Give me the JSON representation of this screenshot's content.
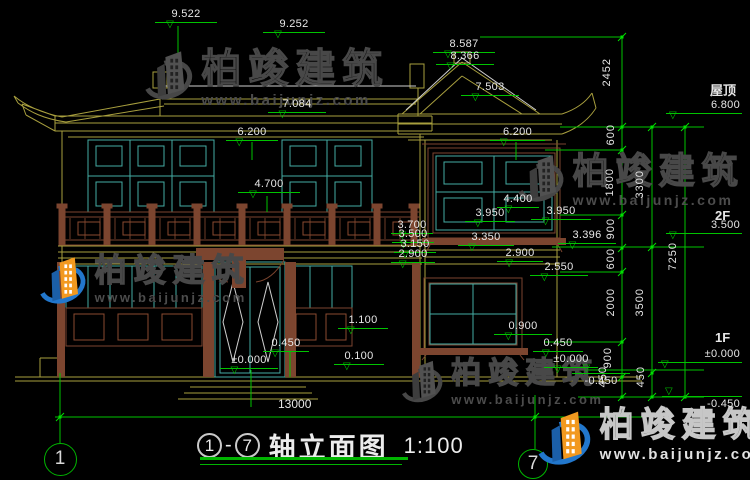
{
  "canvas": {
    "width": 750,
    "height": 480,
    "background": "#000000"
  },
  "colors": {
    "linework_yellow": "#a89f3e",
    "linework_white": "#cfcfcf",
    "window_teal": "#45aca3",
    "wood_brown": "#7c452f",
    "dimension_green": "#00c400",
    "text": "#e6e6e6",
    "logo_blue": "#2277cc",
    "logo_orange": "#f2991f"
  },
  "title": {
    "axis_from": "1",
    "dash": "-",
    "axis_to": "7",
    "label": "轴立面图",
    "scale": "1:100"
  },
  "axis_bubbles": [
    {
      "n": "1",
      "cx": 60,
      "cy": 459,
      "d": 33
    },
    {
      "n": "7",
      "cx": 533,
      "cy": 464,
      "d": 30
    }
  ],
  "watermarks": {
    "brand": "柏竣建筑",
    "url": "www.baijunjz.com",
    "placements": [
      {
        "x": 143,
        "y": 48,
        "variant": "gray",
        "logo_h": 58,
        "brand_size": 40,
        "url_size": 15
      },
      {
        "x": 516,
        "y": 152,
        "variant": "gray",
        "logo_h": 56,
        "brand_size": 36,
        "url_size": 14
      },
      {
        "x": 38,
        "y": 254,
        "variant": "color",
        "logo_h": 56,
        "brand_size": 32,
        "url_size": 13
      },
      {
        "x": 400,
        "y": 358,
        "variant": "gray",
        "logo_h": 50,
        "brand_size": 30,
        "url_size": 13
      },
      {
        "x": 536,
        "y": 408,
        "variant": "bright",
        "logo_h": 64,
        "brand_size": 34,
        "url_size": 15
      }
    ]
  },
  "annotations": {
    "elevations": [
      {
        "t": "9.522",
        "x": 155,
        "y": 8,
        "w": 62
      },
      {
        "t": "9.252",
        "x": 263,
        "y": 18,
        "w": 62
      },
      {
        "t": "8.587",
        "x": 433,
        "y": 38,
        "w": 62
      },
      {
        "t": "8.366",
        "x": 436,
        "y": 50,
        "w": 58
      },
      {
        "t": "7.503",
        "x": 461,
        "y": 81,
        "w": 58
      },
      {
        "t": "7.084",
        "x": 268,
        "y": 98,
        "w": 58
      },
      {
        "t": "6.200",
        "x": 226,
        "y": 126,
        "w": 52
      },
      {
        "t": "6.200",
        "x": 490,
        "y": 126,
        "w": 55
      },
      {
        "t": "4.700",
        "x": 238,
        "y": 178,
        "w": 62
      },
      {
        "t": "4.400",
        "x": 497,
        "y": 193,
        "w": 42
      },
      {
        "t": "3.950",
        "x": 465,
        "y": 207,
        "w": 50
      },
      {
        "t": "3.950",
        "x": 531,
        "y": 205,
        "w": 60
      },
      {
        "t": "3.700",
        "x": 391,
        "y": 219,
        "w": 42
      },
      {
        "t": "3.500",
        "x": 392,
        "y": 228,
        "w": 42
      },
      {
        "t": "3.350",
        "x": 458,
        "y": 231,
        "w": 56
      },
      {
        "t": "3.396",
        "x": 558,
        "y": 229,
        "w": 58
      },
      {
        "t": "3.150",
        "x": 394,
        "y": 238,
        "w": 42
      },
      {
        "t": "2.900",
        "x": 391,
        "y": 248,
        "w": 44
      },
      {
        "t": "2.900",
        "x": 497,
        "y": 247,
        "w": 46
      },
      {
        "t": "2.550",
        "x": 530,
        "y": 261,
        "w": 58
      },
      {
        "t": "1.100",
        "x": 338,
        "y": 314,
        "w": 50
      },
      {
        "t": "0.900",
        "x": 494,
        "y": 320,
        "w": 58
      },
      {
        "t": "0.450",
        "x": 263,
        "y": 337,
        "w": 46
      },
      {
        "t": "0.450",
        "x": 533,
        "y": 337,
        "w": 50
      },
      {
        "t": "0.100",
        "x": 334,
        "y": 350,
        "w": 50
      },
      {
        "t": "±0.000",
        "x": 220,
        "y": 354,
        "w": 58
      },
      {
        "t": "±0.000",
        "x": 544,
        "y": 353,
        "w": 54
      },
      {
        "t": "-0.450",
        "x": 572,
        "y": 373,
        "w": 58,
        "below": true
      },
      {
        "t": "6.800",
        "x": 666,
        "y": 99,
        "w": 76,
        "k": "level"
      },
      {
        "t": "3.500",
        "x": 666,
        "y": 219,
        "w": 76,
        "k": "level"
      },
      {
        "t": "±0.000",
        "x": 658,
        "y": 348,
        "w": 84,
        "k": "level"
      },
      {
        "t": "-0.450",
        "x": 662,
        "y": 396,
        "w": 80,
        "k": "level",
        "below": true
      }
    ],
    "chains": [
      {
        "t": "2452",
        "x": 602,
        "y": 58
      },
      {
        "t": "600",
        "x": 606,
        "y": 124
      },
      {
        "t": "1800",
        "x": 605,
        "y": 168
      },
      {
        "t": "900",
        "x": 606,
        "y": 218
      },
      {
        "t": "600",
        "x": 606,
        "y": 248
      },
      {
        "t": "2000",
        "x": 606,
        "y": 288
      },
      {
        "t": "900",
        "x": 603,
        "y": 347
      },
      {
        "t": "450",
        "x": 598,
        "y": 366
      },
      {
        "t": "3300",
        "x": 635,
        "y": 170
      },
      {
        "t": "3500",
        "x": 635,
        "y": 288
      },
      {
        "t": "450",
        "x": 636,
        "y": 366
      },
      {
        "t": "7250",
        "x": 668,
        "y": 242
      }
    ],
    "texts": [
      {
        "t": "屋顶",
        "x": 710,
        "y": 84,
        "bold": true
      },
      {
        "t": "2F",
        "x": 715,
        "y": 209,
        "bold": true
      },
      {
        "t": "1F",
        "x": 715,
        "y": 331,
        "bold": true
      },
      {
        "t": "13000",
        "x": 278,
        "y": 398,
        "bold": false
      }
    ]
  }
}
